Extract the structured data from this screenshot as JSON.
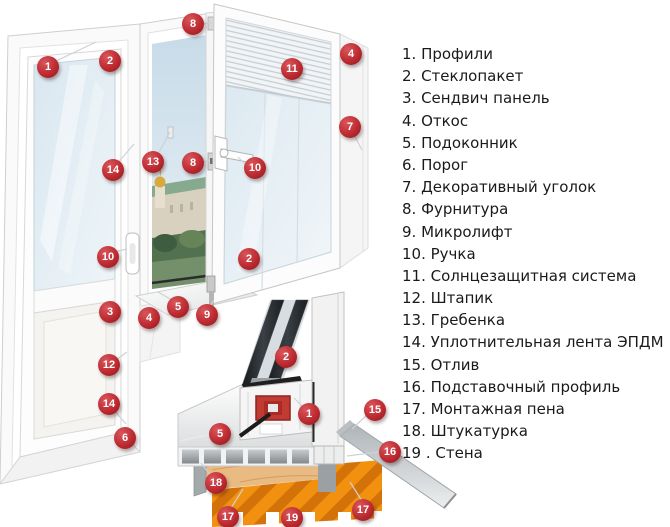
{
  "legend": {
    "items": [
      {
        "text": "1. Профили"
      },
      {
        "text": "2. Стеклопакет"
      },
      {
        "text": "3. Сендвич панель"
      },
      {
        "text": "4. Откос"
      },
      {
        "text": "5. Подоконник"
      },
      {
        "text": "6. Порог"
      },
      {
        "text": "7. Декоративный уголок"
      },
      {
        "text": "8. Фурнитура"
      },
      {
        "text": "9. Микролифт"
      },
      {
        "text": "10. Ручка"
      },
      {
        "text": "11. Солнцезащитная система"
      },
      {
        "text": "12. Штапик"
      },
      {
        "text": "13. Гребенка"
      },
      {
        "text": "14. Уплотнительная лента ЭПДМ"
      },
      {
        "text": "15. Отлив"
      },
      {
        "text": "16. Подставочный профиль"
      },
      {
        "text": "17. Монтажная пена"
      },
      {
        "text": "18. Штукатурка"
      },
      {
        "text": "19 . Стена"
      }
    ]
  },
  "markers": [
    {
      "num": "1",
      "part": "profile-door",
      "x": 48,
      "y": 67
    },
    {
      "num": "2",
      "part": "glazing-door",
      "x": 110,
      "y": 61
    },
    {
      "num": "8",
      "part": "hardware-top",
      "x": 193,
      "y": 24
    },
    {
      "num": "4",
      "part": "slope-top",
      "x": 351,
      "y": 54
    },
    {
      "num": "11",
      "part": "sun-protection",
      "x": 292,
      "y": 69
    },
    {
      "num": "7",
      "part": "decor-corner",
      "x": 350,
      "y": 127
    },
    {
      "num": "13",
      "part": "comb-restrictor",
      "x": 153,
      "y": 162
    },
    {
      "num": "8",
      "part": "hardware-mid",
      "x": 193,
      "y": 163
    },
    {
      "num": "14",
      "part": "seal-door",
      "x": 113,
      "y": 170
    },
    {
      "num": "10",
      "part": "handle-window",
      "x": 255,
      "y": 168
    },
    {
      "num": "10",
      "part": "handle-door",
      "x": 108,
      "y": 257
    },
    {
      "num": "2",
      "part": "glazing-sash",
      "x": 249,
      "y": 259
    },
    {
      "num": "5",
      "part": "sill-window",
      "x": 178,
      "y": 307
    },
    {
      "num": "9",
      "part": "microlift",
      "x": 207,
      "y": 315
    },
    {
      "num": "3",
      "part": "sandwich-panel",
      "x": 110,
      "y": 312
    },
    {
      "num": "4",
      "part": "slope-bottom",
      "x": 149,
      "y": 318
    },
    {
      "num": "12",
      "part": "glazing-bead",
      "x": 109,
      "y": 365
    },
    {
      "num": "14",
      "part": "seal-panel",
      "x": 109,
      "y": 404
    },
    {
      "num": "2",
      "part": "glazing-section",
      "x": 286,
      "y": 357
    },
    {
      "num": "15",
      "part": "drip-sill",
      "x": 375,
      "y": 410
    },
    {
      "num": "1",
      "part": "profile-section",
      "x": 309,
      "y": 414
    },
    {
      "num": "5",
      "part": "sill-section",
      "x": 220,
      "y": 434
    },
    {
      "num": "6",
      "part": "threshold",
      "x": 125,
      "y": 438
    },
    {
      "num": "16",
      "part": "subsill-profile",
      "x": 390,
      "y": 452
    },
    {
      "num": "18",
      "part": "plaster",
      "x": 216,
      "y": 483
    },
    {
      "num": "17",
      "part": "foam-left",
      "x": 228,
      "y": 517
    },
    {
      "num": "19",
      "part": "wall",
      "x": 292,
      "y": 518
    },
    {
      "num": "17",
      "part": "foam-right",
      "x": 363,
      "y": 510
    }
  ],
  "colors": {
    "marker_red": "#bc2b31",
    "marker_red_light": "#d9565b",
    "marker_red_dark": "#8f1317",
    "legend_text": "#1a1a1a",
    "glass_tint": "#dfeaf2",
    "wall_orange": "#f29110",
    "wall_orange_dark": "#d4720a",
    "foam_tan": "#e9ba82",
    "plaster_gray": "#a4a9ac",
    "metal_gray": "#c9cdd0"
  }
}
